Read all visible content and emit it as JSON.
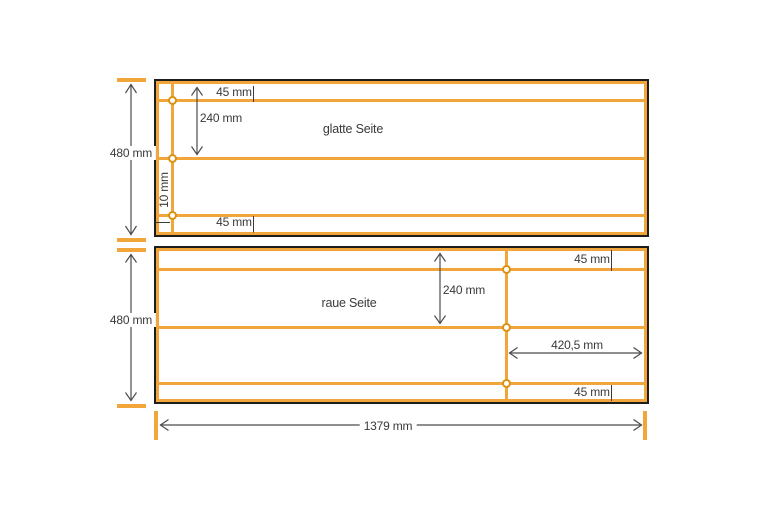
{
  "top_panel": {
    "label": "glatte Seite",
    "dim_height": "480 mm",
    "dim_top_strip": "45 mm",
    "dim_mid": "240 mm",
    "dim_edge_strip": "10 mm",
    "dim_bottom_strip": "45 mm"
  },
  "bottom_panel": {
    "label": "raue Seite",
    "dim_height": "480 mm",
    "dim_top_strip": "45 mm",
    "dim_mid": "240 mm",
    "dim_cut_width": "420,5 mm",
    "dim_bottom_strip": "45 mm"
  },
  "overall": {
    "dim_total_width": "1379 mm"
  },
  "colors": {
    "line_orange": "#F2A53A",
    "hole_ring_orange": "#DB9210",
    "outline_black": "#1D1D1B",
    "dimension_gray": "#4C4C4C",
    "text_dark": "#3A3A38"
  }
}
